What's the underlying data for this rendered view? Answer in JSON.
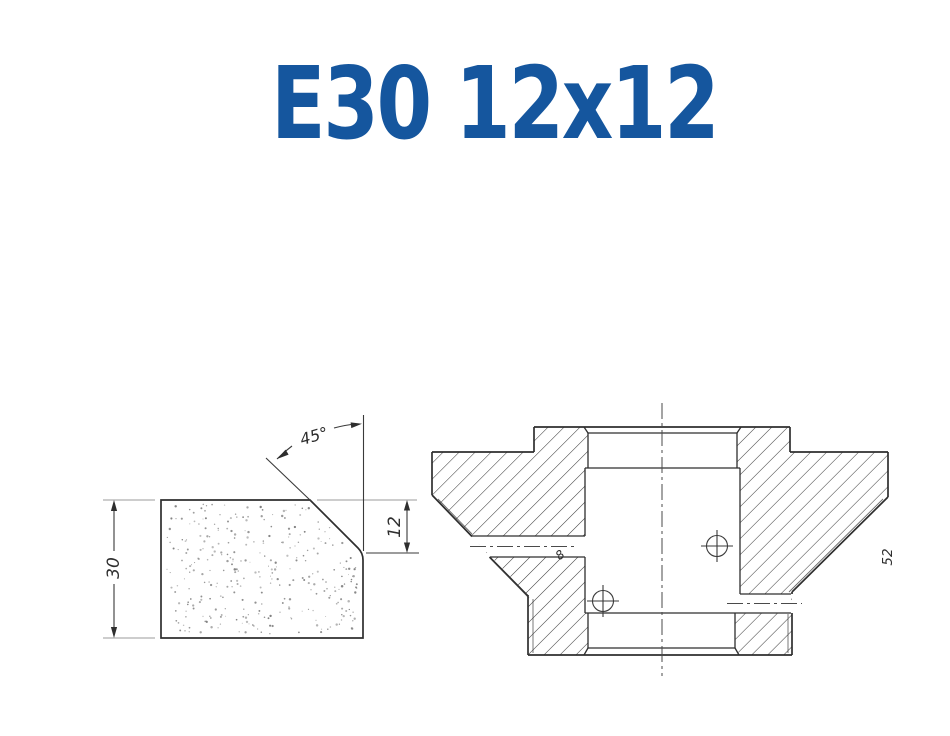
{
  "title": {
    "text": "E30 12x12",
    "color": "#15569e"
  },
  "profile_view": {
    "description": "Abrasive segment profile with 45 degree chamfer, stippled section",
    "height_label": "30",
    "chamfer_label": "12",
    "angle_label": "45°"
  },
  "section_view": {
    "description": "Grinding wheel body cross-section with hatching, bore and radial holes",
    "hole_diameter_label": "8",
    "side_label": "52"
  },
  "colors": {
    "title": "#15569e",
    "line": "#2e2e2e",
    "thin": "#3a3a3a",
    "extension": "#9b9b9b",
    "hatch": "#3c3c3c",
    "centerline": "#4a4a4a",
    "stipple": "#7a7a7a",
    "background": "#ffffff"
  }
}
